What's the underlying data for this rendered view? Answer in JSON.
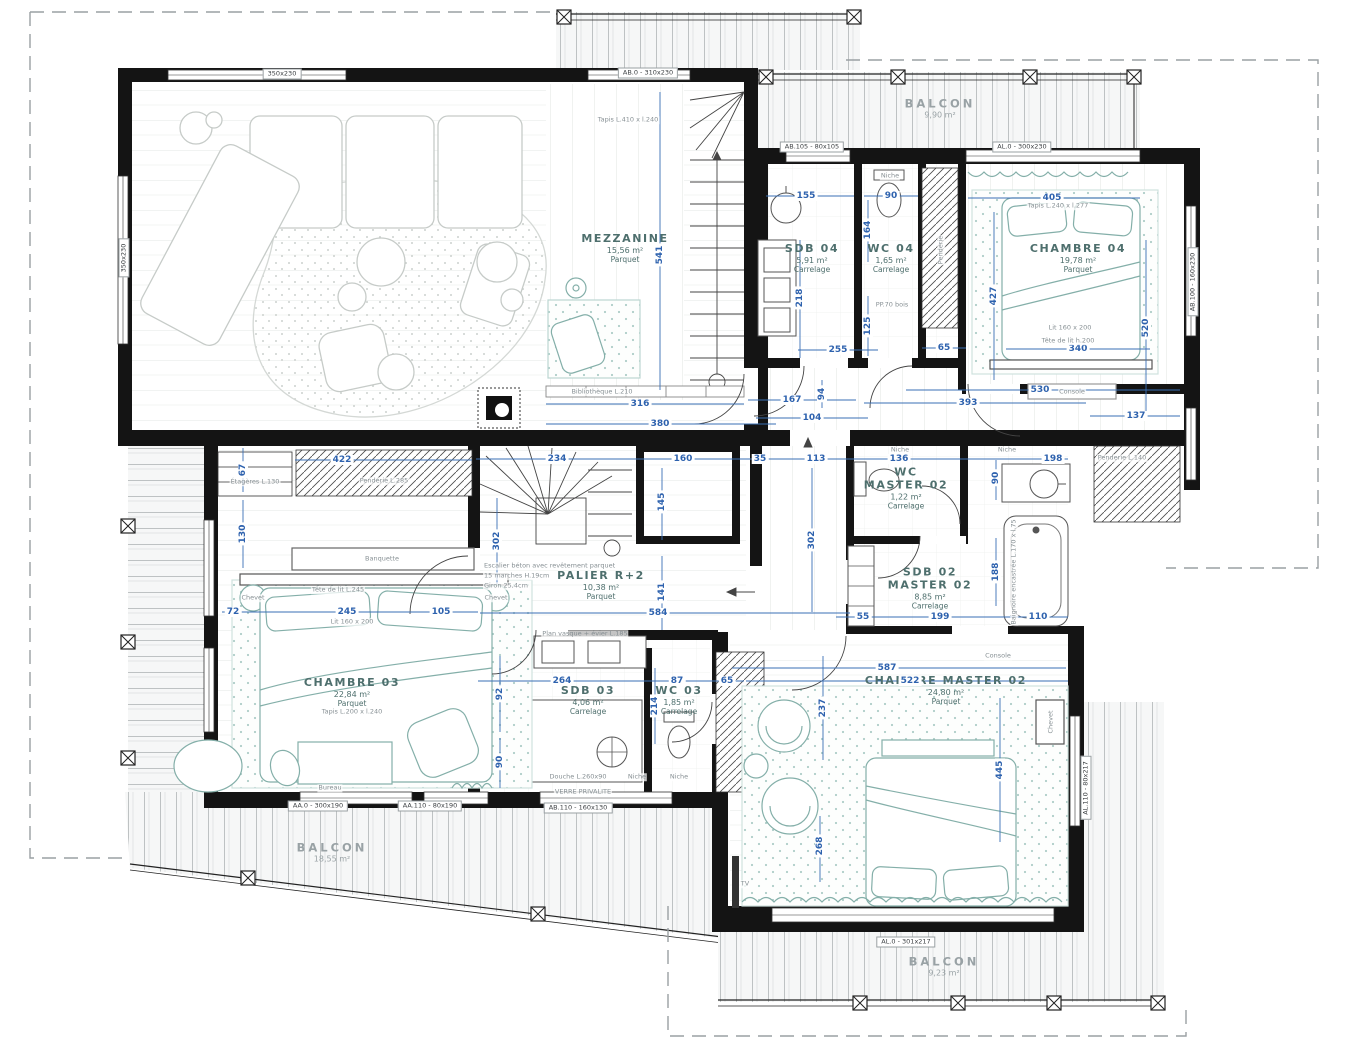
{
  "plan_title": "Plan étage R+2",
  "colors": {
    "wall": "#141414",
    "dimension_blue": "#2e62ae",
    "furniture_teal": "#84afa9",
    "room_label": "#4e6f6d",
    "balcony_label": "#99a2a5"
  },
  "rooms": [
    {
      "id": "mezzanine",
      "name": "MEZZANINE",
      "area": "15,56 m²",
      "floor": "Parquet",
      "x": 625,
      "y": 248
    },
    {
      "id": "sdb-04",
      "name": "SDB 04",
      "area": "5,91 m²",
      "floor": "Carrelage",
      "x": 812,
      "y": 258
    },
    {
      "id": "wc-04",
      "name": "WC 04",
      "area": "1,65 m²",
      "floor": "Carrelage",
      "x": 891,
      "y": 258
    },
    {
      "id": "chambre-04",
      "name": "CHAMBRE 04",
      "area": "19,78 m²",
      "floor": "Parquet",
      "x": 1078,
      "y": 258
    },
    {
      "id": "palier-r2",
      "name": "PALIER R+2",
      "area": "10,38 m²",
      "floor": "Parquet",
      "x": 601,
      "y": 585
    },
    {
      "id": "wc-master-02",
      "name": "WC",
      "name2": "MASTER 02",
      "area": "1,22 m²",
      "floor": "Carrelage",
      "x": 906,
      "y": 488
    },
    {
      "id": "sdb-02-master-02",
      "name": "SDB 02",
      "name2": "MASTER 02",
      "area": "8,85 m²",
      "floor": "Carrelage",
      "x": 930,
      "y": 588
    },
    {
      "id": "chambre-03",
      "name": "CHAMBRE 03",
      "area": "22,84 m²",
      "floor": "Parquet",
      "x": 352,
      "y": 692
    },
    {
      "id": "sdb-03",
      "name": "SDB 03",
      "area": "4,06 m²",
      "floor": "Carrelage",
      "x": 588,
      "y": 700
    },
    {
      "id": "wc-03",
      "name": "WC 03",
      "area": "1,85 m²",
      "floor": "Carrelage",
      "x": 679,
      "y": 700
    },
    {
      "id": "chambre-master-02",
      "name": "CHAMBRE MASTER 02",
      "area": "24,80 m²",
      "floor": "Parquet",
      "x": 946,
      "y": 690
    }
  ],
  "balconies": [
    {
      "id": "balcon-haut",
      "name": "BALCON",
      "area": "9,90 m²",
      "x": 940,
      "y": 108
    },
    {
      "id": "balcon-bas-gauche",
      "name": "BALCON",
      "area": "18,55 m²",
      "x": 332,
      "y": 852
    },
    {
      "id": "balcon-bas-droit",
      "name": "BALCON",
      "area": "9,23 m²",
      "x": 944,
      "y": 966
    }
  ],
  "dimensions": [
    {
      "v": "316",
      "x": 640,
      "y": 404
    },
    {
      "v": "380",
      "x": 660,
      "y": 424
    },
    {
      "v": "167",
      "x": 792,
      "y": 400
    },
    {
      "v": "104",
      "x": 812,
      "y": 418
    },
    {
      "v": "155",
      "x": 806,
      "y": 196
    },
    {
      "v": "90",
      "x": 891,
      "y": 196
    },
    {
      "v": "405",
      "x": 1052,
      "y": 198
    },
    {
      "v": "340",
      "x": 1078,
      "y": 349
    },
    {
      "v": "255",
      "x": 838,
      "y": 350
    },
    {
      "v": "65",
      "x": 944,
      "y": 348
    },
    {
      "v": "530",
      "x": 1040,
      "y": 390
    },
    {
      "v": "393",
      "x": 968,
      "y": 403
    },
    {
      "v": "137",
      "x": 1136,
      "y": 416
    },
    {
      "v": "234",
      "x": 557,
      "y": 459
    },
    {
      "v": "160",
      "x": 683,
      "y": 459
    },
    {
      "v": "35",
      "x": 760,
      "y": 459
    },
    {
      "v": "113",
      "x": 816,
      "y": 459
    },
    {
      "v": "136",
      "x": 899,
      "y": 459
    },
    {
      "v": "198",
      "x": 1053,
      "y": 459
    },
    {
      "v": "422",
      "x": 342,
      "y": 460
    },
    {
      "v": "245",
      "x": 347,
      "y": 612
    },
    {
      "v": "105",
      "x": 441,
      "y": 612
    },
    {
      "v": "72",
      "x": 233,
      "y": 612
    },
    {
      "v": "584",
      "x": 658,
      "y": 613
    },
    {
      "v": "264",
      "x": 562,
      "y": 681
    },
    {
      "v": "87",
      "x": 677,
      "y": 681
    },
    {
      "v": "65",
      "x": 727,
      "y": 681
    },
    {
      "v": "587",
      "x": 887,
      "y": 668
    },
    {
      "v": "522",
      "x": 910,
      "y": 681
    },
    {
      "v": "199",
      "x": 940,
      "y": 617
    },
    {
      "v": "110",
      "x": 1038,
      "y": 617
    },
    {
      "v": "55",
      "x": 863,
      "y": 617
    },
    {
      "v": "541",
      "x": 660,
      "y": 255,
      "o": "v"
    },
    {
      "v": "218",
      "x": 800,
      "y": 298,
      "o": "v"
    },
    {
      "v": "164",
      "x": 868,
      "y": 230,
      "o": "v"
    },
    {
      "v": "125",
      "x": 868,
      "y": 326,
      "o": "v"
    },
    {
      "v": "427",
      "x": 994,
      "y": 296,
      "o": "v"
    },
    {
      "v": "520",
      "x": 1146,
      "y": 328,
      "o": "v"
    },
    {
      "v": "145",
      "x": 662,
      "y": 502,
      "o": "v"
    },
    {
      "v": "141",
      "x": 662,
      "y": 592,
      "o": "v"
    },
    {
      "v": "302",
      "x": 497,
      "y": 541,
      "o": "v"
    },
    {
      "v": "302",
      "x": 812,
      "y": 540,
      "o": "v"
    },
    {
      "v": "94",
      "x": 822,
      "y": 394,
      "o": "v"
    },
    {
      "v": "90",
      "x": 996,
      "y": 478,
      "o": "v"
    },
    {
      "v": "188",
      "x": 996,
      "y": 572,
      "o": "v"
    },
    {
      "v": "445",
      "x": 1000,
      "y": 770,
      "o": "v"
    },
    {
      "v": "237",
      "x": 823,
      "y": 708,
      "o": "v"
    },
    {
      "v": "268",
      "x": 820,
      "y": 846,
      "o": "v"
    },
    {
      "v": "67",
      "x": 243,
      "y": 470,
      "o": "v"
    },
    {
      "v": "130",
      "x": 243,
      "y": 534,
      "o": "v"
    },
    {
      "v": "92",
      "x": 500,
      "y": 694,
      "o": "v"
    },
    {
      "v": "90",
      "x": 500,
      "y": 762,
      "o": "v"
    },
    {
      "v": "214",
      "x": 655,
      "y": 706,
      "o": "v"
    }
  ],
  "window_labels": [
    {
      "t": "350x230",
      "x": 282,
      "y": 74
    },
    {
      "t": "AB.0 - 310x230",
      "x": 648,
      "y": 73
    },
    {
      "t": "AB.105 - 80x105",
      "x": 812,
      "y": 147
    },
    {
      "t": "AL.0 - 300x230",
      "x": 1022,
      "y": 147
    },
    {
      "t": "350x230",
      "x": 124,
      "y": 258,
      "r": 1
    },
    {
      "t": "AB.100 - 160x230",
      "x": 1193,
      "y": 282,
      "r": 1
    },
    {
      "t": "AA.0 - 300x190",
      "x": 318,
      "y": 806
    },
    {
      "t": "AA.110 - 80x190",
      "x": 430,
      "y": 806
    },
    {
      "t": "AB.110 - 160x130",
      "x": 578,
      "y": 808
    },
    {
      "t": "AL.0 - 301x217",
      "x": 906,
      "y": 942
    },
    {
      "t": "AL.110 - 80x217",
      "x": 1086,
      "y": 788,
      "r": 1
    }
  ],
  "annotations": [
    {
      "t": "Bibliothèque L.210",
      "x": 602,
      "y": 392
    },
    {
      "t": "Tapis L.410 x l.240",
      "x": 628,
      "y": 120
    },
    {
      "t": "Tapis L.240 x l.277",
      "x": 1058,
      "y": 206
    },
    {
      "t": "Lit 160 x 200",
      "x": 1070,
      "y": 328
    },
    {
      "t": "Tête de lit h.200",
      "x": 1068,
      "y": 341
    },
    {
      "t": "Console",
      "x": 1072,
      "y": 392
    },
    {
      "t": "Niche",
      "x": 890,
      "y": 176
    },
    {
      "t": "PP.70 bois",
      "x": 892,
      "y": 305
    },
    {
      "t": "Penderie",
      "x": 941,
      "y": 250,
      "r": 1
    },
    {
      "t": "Étagères L.130",
      "x": 255,
      "y": 482
    },
    {
      "t": "Penderie L.285",
      "x": 384,
      "y": 481
    },
    {
      "t": "Banquette",
      "x": 382,
      "y": 559
    },
    {
      "t": "Tête de lit L.245",
      "x": 338,
      "y": 590
    },
    {
      "t": "Lit 160 x 200",
      "x": 352,
      "y": 622
    },
    {
      "t": "Tapis L.200 x l.240",
      "x": 352,
      "y": 712
    },
    {
      "t": "Chevet",
      "x": 253,
      "y": 598
    },
    {
      "t": "Chevet",
      "x": 496,
      "y": 598
    },
    {
      "t": "Bureau",
      "x": 330,
      "y": 788
    },
    {
      "t": "Escalier béton avec revêtement parquet",
      "x": 483,
      "y": 566,
      "a": 1
    },
    {
      "t": "15 marches H.19cm",
      "x": 483,
      "y": 576,
      "a": 1
    },
    {
      "t": "Giron 25,4cm",
      "x": 483,
      "y": 586,
      "a": 1
    },
    {
      "t": "Plan vasque + évier L.185",
      "x": 585,
      "y": 634
    },
    {
      "t": "Douche L.260x90",
      "x": 578,
      "y": 777
    },
    {
      "t": "VERRE PRIVALITE",
      "x": 583,
      "y": 792
    },
    {
      "t": "Niche",
      "x": 637,
      "y": 777
    },
    {
      "t": "Niche",
      "x": 679,
      "y": 777
    },
    {
      "t": "Niche",
      "x": 900,
      "y": 450
    },
    {
      "t": "Niche",
      "x": 1007,
      "y": 450
    },
    {
      "t": "Baignoire encastrée L.170 x l.75",
      "x": 1014,
      "y": 572,
      "r": 1
    },
    {
      "t": "Console",
      "x": 998,
      "y": 656
    },
    {
      "t": "Chevet",
      "x": 1051,
      "y": 722,
      "r": 1
    },
    {
      "t": "TV",
      "x": 745,
      "y": 884
    },
    {
      "t": "Penderie L.140",
      "x": 1122,
      "y": 458
    }
  ]
}
